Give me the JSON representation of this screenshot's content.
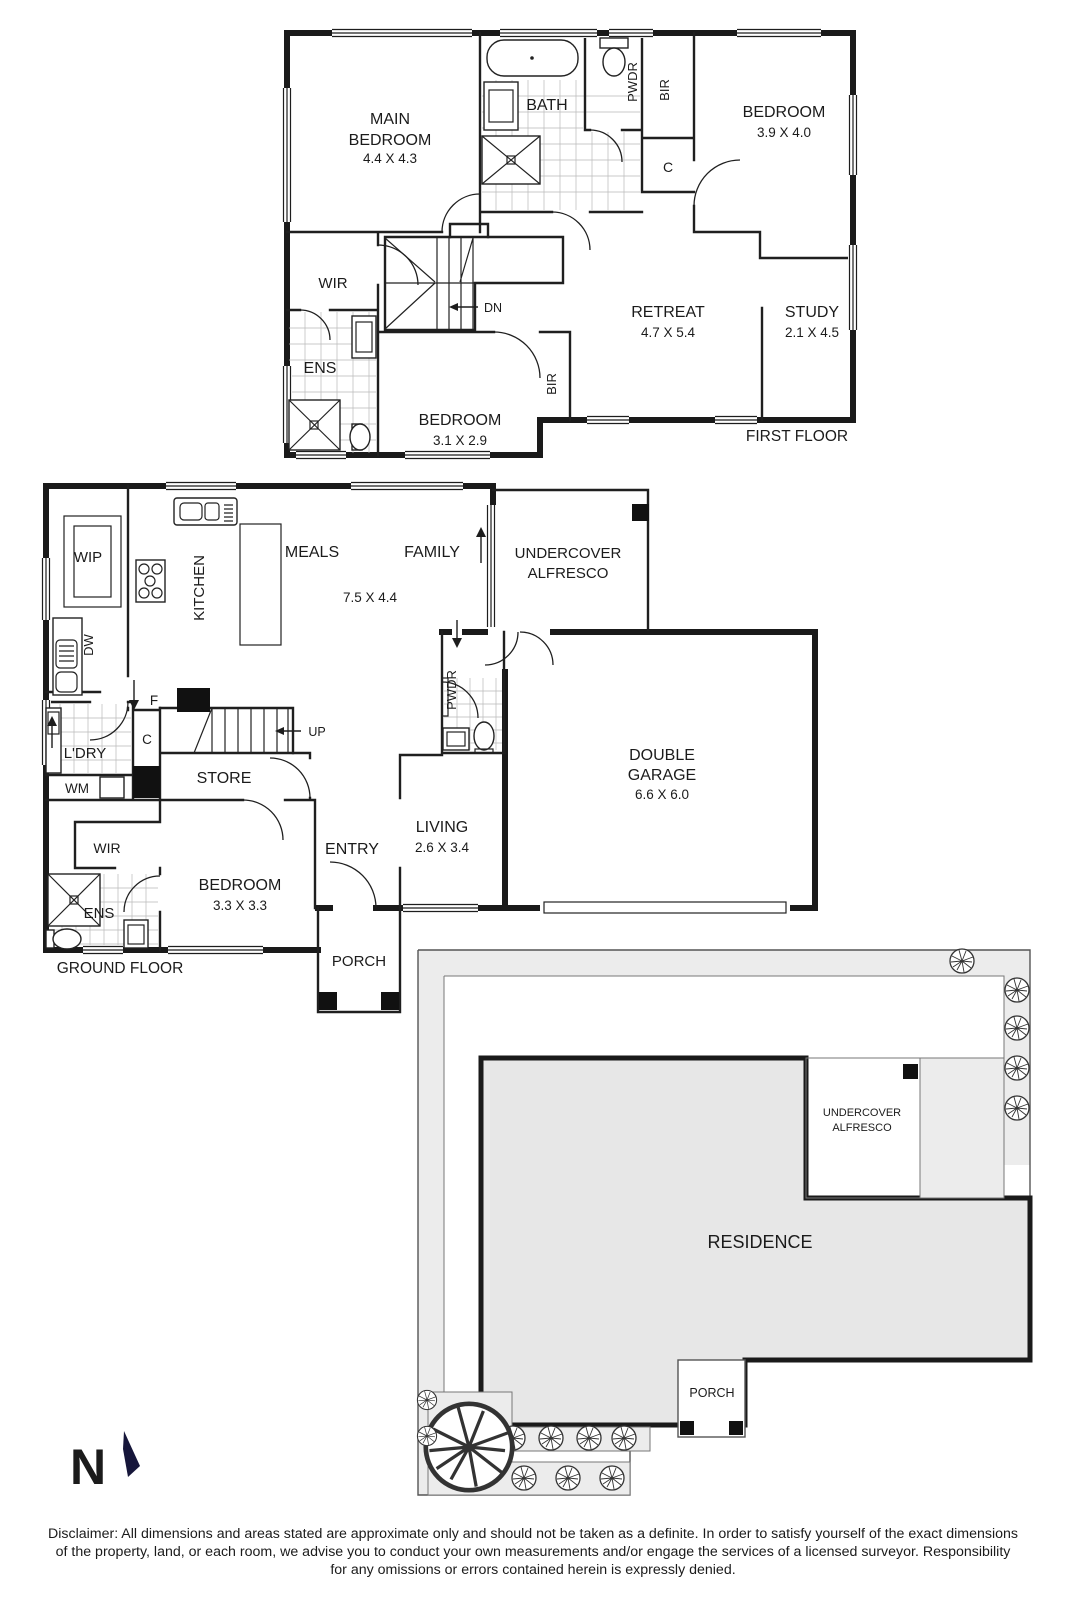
{
  "document_type": "floorplan",
  "colors": {
    "wall": "#1a1a1a",
    "line": "#1f1f1f",
    "site_band": "#ececec",
    "residence_fill": "#e7e7e7",
    "north_arrow": "#16163a",
    "background": "#ffffff"
  },
  "first_floor": {
    "title": "FIRST FLOOR",
    "labels": [
      {
        "t": "MAIN",
        "x": 390,
        "y": 124,
        "s": 16,
        "n": "room-label-main-bedroom"
      },
      {
        "t": "BEDROOM",
        "x": 390,
        "y": 145,
        "s": 16,
        "n": "room-label-main-bedroom"
      },
      {
        "t": "4.4 X 4.3",
        "x": 390,
        "y": 163,
        "s": 13.5,
        "n": "room-dim-main-bedroom"
      },
      {
        "t": "BATH",
        "x": 547,
        "y": 110,
        "s": 16,
        "n": "room-label-bath"
      },
      {
        "t": "PWDR",
        "x": 637,
        "y": 82,
        "s": 13,
        "r": -90,
        "n": "room-label-pwdr"
      },
      {
        "t": "BIR",
        "x": 669,
        "y": 90,
        "s": 13,
        "r": -90,
        "n": "room-label-bir"
      },
      {
        "t": "C",
        "x": 668,
        "y": 172,
        "s": 14,
        "n": "room-label-closet"
      },
      {
        "t": "BEDROOM",
        "x": 784,
        "y": 117,
        "s": 16,
        "n": "room-label-bedroom-2"
      },
      {
        "t": "3.9 X 4.0",
        "x": 784,
        "y": 137,
        "s": 13.5,
        "n": "room-dim-bedroom-2"
      },
      {
        "t": "WIR",
        "x": 333,
        "y": 288,
        "s": 15,
        "n": "room-label-wir"
      },
      {
        "t": "DN",
        "x": 493,
        "y": 312,
        "s": 12.5,
        "n": "stairs-down-label"
      },
      {
        "t": "ENS",
        "x": 320,
        "y": 373,
        "s": 16,
        "n": "room-label-ens"
      },
      {
        "t": "BEDROOM",
        "x": 460,
        "y": 425,
        "s": 16,
        "n": "room-label-bedroom-3"
      },
      {
        "t": "3.1 X 2.9",
        "x": 460,
        "y": 445,
        "s": 13.5,
        "n": "room-dim-bedroom-3"
      },
      {
        "t": "BIR",
        "x": 556,
        "y": 384,
        "s": 13,
        "r": -90,
        "n": "room-label-bir-2"
      },
      {
        "t": "RETREAT",
        "x": 668,
        "y": 317,
        "s": 16,
        "n": "room-label-retreat"
      },
      {
        "t": "4.7 X 5.4",
        "x": 668,
        "y": 337,
        "s": 13.5,
        "n": "room-dim-retreat"
      },
      {
        "t": "STUDY",
        "x": 812,
        "y": 317,
        "s": 16,
        "n": "room-label-study"
      },
      {
        "t": "2.1 X 4.5",
        "x": 812,
        "y": 337,
        "s": 13.5,
        "n": "room-dim-study"
      }
    ]
  },
  "ground_floor": {
    "title": "GROUND FLOOR",
    "labels": [
      {
        "t": "WIP",
        "x": 88,
        "y": 562,
        "s": 15,
        "n": "room-label-wip"
      },
      {
        "t": "KITCHEN",
        "x": 204,
        "y": 588,
        "s": 15,
        "r": -90,
        "n": "room-label-kitchen"
      },
      {
        "t": "MEALS",
        "x": 312,
        "y": 557,
        "s": 16,
        "n": "room-label-meals"
      },
      {
        "t": "7.5 X 4.4",
        "x": 370,
        "y": 602,
        "s": 13.5,
        "n": "room-dim-meals-family"
      },
      {
        "t": "FAMILY",
        "x": 432,
        "y": 557,
        "s": 16,
        "n": "room-label-family"
      },
      {
        "t": "UNDERCOVER",
        "x": 568,
        "y": 558,
        "s": 15,
        "n": "room-label-alfresco"
      },
      {
        "t": "ALFRESCO",
        "x": 568,
        "y": 578,
        "s": 15,
        "n": "room-label-alfresco"
      },
      {
        "t": "DW",
        "x": 93,
        "y": 645,
        "s": 13,
        "r": -90,
        "n": "fixture-label-dishwasher"
      },
      {
        "t": "F",
        "x": 154,
        "y": 705,
        "s": 13.5,
        "n": "fixture-label-fridge"
      },
      {
        "t": "PWDR",
        "x": 456,
        "y": 690,
        "s": 13,
        "r": -90,
        "n": "room-label-pwdr"
      },
      {
        "t": "C",
        "x": 147,
        "y": 744,
        "s": 13.5,
        "n": "room-label-closet"
      },
      {
        "t": "L'DRY",
        "x": 85,
        "y": 758,
        "s": 15,
        "n": "room-label-laundry"
      },
      {
        "t": "WM",
        "x": 77,
        "y": 793,
        "s": 13.5,
        "n": "fixture-label-washing-machine"
      },
      {
        "t": "STORE",
        "x": 224,
        "y": 783,
        "s": 16,
        "n": "room-label-store"
      },
      {
        "t": "UP",
        "x": 317,
        "y": 736,
        "s": 12.5,
        "n": "stairs-up-label"
      },
      {
        "t": "WIR",
        "x": 107,
        "y": 853,
        "s": 14,
        "n": "room-label-wir"
      },
      {
        "t": "BEDROOM",
        "x": 240,
        "y": 890,
        "s": 16,
        "n": "room-label-bedroom"
      },
      {
        "t": "3.3 X 3.3",
        "x": 240,
        "y": 910,
        "s": 13.5,
        "n": "room-dim-bedroom"
      },
      {
        "t": "ENS",
        "x": 99,
        "y": 918,
        "s": 15,
        "n": "room-label-ens"
      },
      {
        "t": "ENTRY",
        "x": 352,
        "y": 854,
        "s": 16,
        "n": "room-label-entry"
      },
      {
        "t": "LIVING",
        "x": 442,
        "y": 832,
        "s": 16,
        "n": "room-label-living"
      },
      {
        "t": "2.6 X 3.4",
        "x": 442,
        "y": 852,
        "s": 13.5,
        "n": "room-dim-living"
      },
      {
        "t": "PORCH",
        "x": 359,
        "y": 966,
        "s": 15,
        "n": "room-label-porch"
      },
      {
        "t": "DOUBLE",
        "x": 662,
        "y": 760,
        "s": 16,
        "n": "room-label-garage"
      },
      {
        "t": "GARAGE",
        "x": 662,
        "y": 780,
        "s": 16,
        "n": "room-label-garage"
      },
      {
        "t": "6.6 X 6.0",
        "x": 662,
        "y": 799,
        "s": 13.5,
        "n": "room-dim-garage"
      }
    ]
  },
  "site_plan": {
    "labels": [
      {
        "t": "UNDERCOVER",
        "x": 862,
        "y": 1116,
        "s": 11,
        "n": "site-label-alfresco"
      },
      {
        "t": "ALFRESCO",
        "x": 862,
        "y": 1131,
        "s": 11,
        "n": "site-label-alfresco"
      },
      {
        "t": "RESIDENCE",
        "x": 760,
        "y": 1248,
        "s": 18,
        "n": "site-label-residence"
      },
      {
        "t": "PORCH",
        "x": 712,
        "y": 1397,
        "s": 12.5,
        "n": "site-label-porch"
      }
    ]
  },
  "north_indicator": {
    "letter": "N"
  },
  "disclaimer": {
    "lines": [
      "Disclaimer: All dimensions and areas stated are approximate only and should not be taken as a definite. In order to satisfy yourself of the exact dimensions",
      "of the property, land, or each room, we advise you to conduct your own measurements and/or engage the services of a licensed surveyor. Responsibility",
      "for any omissions or errors contained herein is expressly denied."
    ]
  }
}
